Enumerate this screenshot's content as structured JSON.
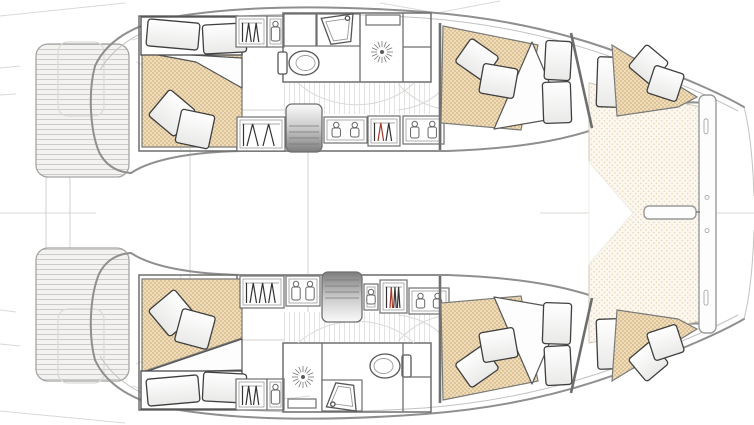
{
  "diagram": {
    "kind": "catamaran-floor-plan",
    "view": "deck-plan-top-view",
    "vessel": {
      "hulls": 2,
      "double_cabins": 4,
      "bathrooms": 2,
      "trampoline": true,
      "swim_platforms": 2
    }
  },
  "colors": {
    "background": "#ffffff",
    "hull_outline": "#8f8f8f",
    "wall": "#6e6e6e",
    "faint_deck": "#d9d9d7",
    "mattress_fill": "#eedcbb",
    "mattress_dot": "#c69f62",
    "trampoline_fill": "#fcf8f0",
    "trampoline_dot": "#e6d5b4",
    "plank_fill": "#f3f2f0",
    "plank_line": "#cbcbc9",
    "vplank_line": "#e3e3e1",
    "steps_dark": "#7d7d7d",
    "pillow_stroke": "#3f3f3f",
    "hanger_accent_red": "#a33a2a"
  },
  "canvas": {
    "width": 754,
    "height": 425
  },
  "items": [
    {
      "t": "line",
      "x1": 0,
      "y1": 16,
      "x2": 125,
      "y2": 3,
      "cls": "faint",
      "name": "stern-rig-line-top"
    },
    {
      "t": "line",
      "x1": 0,
      "y1": 411,
      "x2": 125,
      "y2": 423,
      "cls": "faint",
      "name": "stern-rig-line-bottom"
    },
    {
      "t": "line",
      "x1": 0,
      "y1": 68,
      "x2": 20,
      "y2": 66,
      "cls": "faint",
      "name": "edge-tick"
    },
    {
      "t": "line",
      "x1": 0,
      "y1": 95,
      "x2": 16,
      "y2": 94,
      "cls": "faint",
      "name": "edge-tick"
    },
    {
      "t": "line",
      "x1": 0,
      "y1": 310,
      "x2": 16,
      "y2": 312,
      "cls": "faint",
      "name": "edge-tick"
    },
    {
      "t": "line",
      "x1": 0,
      "y1": 344,
      "x2": 20,
      "y2": 346,
      "cls": "faint",
      "name": "edge-tick"
    },
    {
      "t": "line",
      "x1": 0,
      "y1": 213,
      "x2": 96,
      "y2": 213,
      "cls": "faint",
      "name": "centerline-aft"
    },
    {
      "t": "line",
      "x1": 540,
      "y1": 213,
      "x2": 644,
      "y2": 213,
      "cls": "faint",
      "name": "centerline-fwd"
    },
    {
      "t": "line",
      "x1": 697,
      "y1": 213,
      "x2": 754,
      "y2": 213,
      "cls": "faint",
      "name": "centerline-bow"
    },
    {
      "t": "path",
      "d": "M380,3 L437,13 L500,1",
      "cls": "faint",
      "name": "rig-lines-top"
    },
    {
      "t": "rect",
      "x": 190,
      "y": 110,
      "w": 118,
      "h": 230,
      "rx": 16,
      "cls": "faintbox",
      "name": "cockpit-outline"
    },
    {
      "t": "rect",
      "x": 46,
      "y": 172,
      "w": 24,
      "h": 84,
      "rx": 9,
      "cls": "faintbox",
      "name": "aft-platform-outline"
    },
    {
      "t": "path",
      "d": "M132,40 C180,26 250,22 310,30",
      "cls": "faint",
      "name": "cockpit-seat-line"
    },
    {
      "t": "path",
      "d": "M132,386 C180,400 250,404 310,396",
      "cls": "faint",
      "name": "cockpit-seat-line"
    },
    {
      "t": "path",
      "d": "M136,62 C168,74 178,112 181,152",
      "cls": "faint",
      "name": "cockpit-seat-line"
    },
    {
      "t": "path",
      "d": "M136,364 C168,352 178,314 181,274",
      "cls": "faint",
      "name": "cockpit-seat-line"
    },
    {
      "t": "path",
      "d": "M744,107 C750,130 753,165 754,196",
      "cls": "hullthin",
      "name": "bow-bridle-top"
    },
    {
      "t": "path",
      "d": "M744,319 C750,296 753,261 754,230",
      "cls": "hullthin",
      "name": "bow-bridle-bottom"
    },
    {
      "t": "planks",
      "x": 36,
      "y": 44,
      "w": 93,
      "h": 133,
      "rx": 12,
      "name": "swim-platform-top"
    },
    {
      "t": "rect",
      "x": 58,
      "y": 42,
      "w": 46,
      "h": 74,
      "rx": 10,
      "cls": "faintbox",
      "name": "transom-step-outline"
    },
    {
      "t": "planks",
      "x": 36,
      "y": 248,
      "w": 93,
      "h": 133,
      "rx": 12,
      "name": "swim-platform-bottom"
    },
    {
      "t": "rect",
      "x": 58,
      "y": 309,
      "w": 46,
      "h": 74,
      "rx": 10,
      "cls": "faintbox",
      "name": "transom-step-outline"
    },
    {
      "t": "path",
      "d": "M95,66 C105,44 128,28 162,19 C235,5 330,5 425,12 C505,18 575,35 633,58 C684,78 718,92 744,107",
      "cls": "hull",
      "name": "hull-port-outer"
    },
    {
      "t": "path",
      "d": "M100,70 C112,50 132,34 164,25 C236,12 330,12 424,18 C502,24 570,41 628,63 C678,83 712,97 738,111",
      "cls": "hullthin",
      "name": "hull-port-toerail"
    },
    {
      "t": "path",
      "d": "M131,173 C152,159 192,152 242,151 L448,151 C532,148 578,137 617,121 C652,107 680,100 703,103",
      "cls": "hull",
      "name": "hull-port-inner"
    },
    {
      "t": "path",
      "d": "M95,66 C88,92 90,130 99,152 C106,166 117,172 131,173",
      "cls": "hull",
      "name": "hull-port-stern"
    },
    {
      "t": "path",
      "d": "M95,360 C105,382 128,398 162,407 C235,421 330,421 425,414 C505,408 575,391 633,368 C684,348 718,334 744,319",
      "cls": "hull",
      "name": "hull-starboard-outer"
    },
    {
      "t": "path",
      "d": "M100,356 C112,376 132,392 164,401 C236,414 330,414 424,408 C502,402 570,385 628,363 C678,343 712,329 738,315",
      "cls": "hullthin",
      "name": "hull-starboard-toerail"
    },
    {
      "t": "path",
      "d": "M131,253 C152,267 192,274 242,275 L448,275 C532,278 578,289 617,305 C652,319 680,326 703,323",
      "cls": "hull",
      "name": "hull-starboard-inner"
    },
    {
      "t": "path",
      "d": "M95,360 C88,334 90,296 99,274 C106,260 117,254 131,253",
      "cls": "hull",
      "name": "hull-starboard-stern"
    },
    {
      "t": "tramp",
      "pts": [
        [
          589,
          83
        ],
        [
          701,
          107
        ],
        [
          701,
          321
        ],
        [
          589,
          343
        ]
      ],
      "name": "trampoline"
    },
    {
      "t": "poly",
      "pts": [
        [
          589,
          162
        ],
        [
          633,
          213
        ],
        [
          589,
          264
        ]
      ],
      "cls": "wedge",
      "name": "foredeck-wedge"
    },
    {
      "t": "beam",
      "x": 699,
      "y": 95,
      "w": 17,
      "h": 238,
      "name": "forward-crossbeam"
    },
    {
      "t": "bowsprit",
      "x": 644,
      "y": 206,
      "w": 52,
      "h": 13,
      "name": "bowsprit"
    },
    {
      "t": "line",
      "x1": 696,
      "y1": 212,
      "x2": 700,
      "y2": 212,
      "cls": "wall",
      "name": "bowsprit-link"
    },
    {
      "t": "rect",
      "x": 139,
      "y": 16,
      "w": 98,
      "h": 135,
      "cls": "room",
      "name": "aft-cabin-port"
    },
    {
      "t": "mattress",
      "pts": [
        [
          142,
          54
        ],
        [
          242,
          54
        ],
        [
          242,
          147
        ],
        [
          142,
          147
        ]
      ],
      "name": "aft-cabin-port-mattress"
    },
    {
      "t": "duvet",
      "pts": [
        [
          142,
          52
        ],
        [
          242,
          58
        ],
        [
          242,
          88
        ],
        [
          196,
          62
        ]
      ],
      "name": "duvet"
    },
    {
      "t": "rect",
      "x": 141,
      "y": 17,
      "w": 101,
      "h": 38,
      "cls": "bed",
      "name": "aft-cabin-port-bedhead"
    },
    {
      "t": "pillow",
      "x": 147,
      "y": 21,
      "w": 52,
      "h": 27,
      "rot": 5,
      "name": "pillow"
    },
    {
      "t": "pillow",
      "x": 203,
      "y": 24,
      "w": 43,
      "h": 29,
      "rot": -3,
      "name": "pillow"
    },
    {
      "t": "pillow",
      "x": 155,
      "y": 96,
      "w": 34,
      "h": 34,
      "rot": 40,
      "name": "throw-pillow"
    },
    {
      "t": "pillow",
      "x": 178,
      "y": 112,
      "w": 34,
      "h": 34,
      "rot": 12,
      "name": "throw-pillow"
    },
    {
      "t": "locker",
      "x": 236,
      "y": 16,
      "w": 31,
      "h": 31,
      "hangers": 2,
      "name": "wardrobe"
    },
    {
      "t": "shelf",
      "x": 267,
      "y": 16,
      "w": 17,
      "h": 31,
      "jars": 1,
      "name": "shelf-unit"
    },
    {
      "t": "rect",
      "x": 283,
      "y": 13,
      "w": 148,
      "h": 69,
      "cls": "room",
      "name": "bathroom-port"
    },
    {
      "t": "rect",
      "x": 284,
      "y": 14,
      "w": 32,
      "h": 32,
      "cls": "cab",
      "name": "bathroom-cabinet"
    },
    {
      "t": "rect",
      "x": 317,
      "y": 14,
      "w": 43,
      "h": 32,
      "cls": "cab",
      "name": "vanity"
    },
    {
      "t": "sink",
      "x": 322,
      "y": 16,
      "w": 34,
      "h": 27,
      "rot": -8,
      "name": "sink"
    },
    {
      "t": "toilet",
      "cx": 304,
      "cy": 63,
      "facing": "right",
      "name": "toilet"
    },
    {
      "t": "line",
      "x1": 360,
      "y1": 13,
      "x2": 360,
      "y2": 82,
      "cls": "wall",
      "name": "shower-wall"
    },
    {
      "t": "rect",
      "x": 366,
      "y": 15,
      "w": 34,
      "h": 10,
      "cls": "cab",
      "name": "shower-bench"
    },
    {
      "t": "shower",
      "cx": 382,
      "cy": 52,
      "name": "shower-drain"
    },
    {
      "t": "line",
      "x1": 403,
      "y1": 13,
      "x2": 403,
      "y2": 82,
      "cls": "wall",
      "name": "bathroom-wall"
    },
    {
      "t": "line",
      "x1": 403,
      "y1": 47,
      "x2": 431,
      "y2": 47,
      "cls": "wall",
      "name": "cabinet-divider"
    },
    {
      "t": "vfloor",
      "x": 284,
      "y": 83,
      "w": 146,
      "h": 31,
      "name": "corridor-floor"
    },
    {
      "t": "path",
      "d": "M298,83 C330,112 384,112 414,83",
      "cls": "faint",
      "name": "door-swing"
    },
    {
      "t": "path",
      "d": "M398,84 C415,102 432,108 448,110",
      "cls": "faint",
      "name": "floor-mark"
    },
    {
      "t": "path",
      "d": "M448,84 C432,102 415,108 398,110",
      "cls": "faint",
      "name": "floor-mark"
    },
    {
      "t": "locker",
      "x": 237,
      "y": 117,
      "w": 48,
      "h": 34,
      "hangers": 2,
      "name": "hanging-locker"
    },
    {
      "t": "steps",
      "x": 286,
      "y": 104,
      "w": 36,
      "h": 48,
      "dark": "bottom",
      "name": "companionway-steps-port"
    },
    {
      "t": "shelf",
      "x": 324,
      "y": 117,
      "w": 43,
      "h": 26,
      "jars": 2,
      "name": "shelf-unit"
    },
    {
      "t": "locker",
      "x": 368,
      "y": 116,
      "w": 32,
      "h": 30,
      "hangers": 2,
      "red": 1,
      "name": "hanging-locker"
    },
    {
      "t": "shelf",
      "x": 403,
      "y": 116,
      "w": 41,
      "h": 28,
      "jars": 2,
      "name": "shelf-unit"
    },
    {
      "t": "line",
      "x1": 440,
      "y1": 23,
      "x2": 440,
      "y2": 150,
      "cls": "wall2",
      "name": "cabin-bulkhead"
    },
    {
      "t": "mattress",
      "pts": [
        [
          443,
          26
        ],
        [
          538,
          45
        ],
        [
          521,
          130
        ],
        [
          441,
          123
        ]
      ],
      "name": "fwd-cabin-port-mattress"
    },
    {
      "t": "duvet",
      "pts": [
        [
          532,
          42
        ],
        [
          564,
          117
        ],
        [
          494,
          129
        ]
      ],
      "name": "duvet"
    },
    {
      "t": "pillow",
      "x": 460,
      "y": 45,
      "w": 34,
      "h": 29,
      "rot": 35,
      "name": "throw-pillow"
    },
    {
      "t": "pillow",
      "x": 481,
      "y": 66,
      "w": 35,
      "h": 30,
      "rot": 10,
      "name": "throw-pillow"
    },
    {
      "t": "pillow",
      "x": 545,
      "y": 41,
      "w": 26,
      "h": 39,
      "rot": 3,
      "name": "pillow"
    },
    {
      "t": "pillow",
      "x": 543,
      "y": 82,
      "w": 28,
      "h": 41,
      "rot": -2,
      "name": "pillow"
    },
    {
      "t": "line",
      "x1": 571,
      "y1": 33,
      "x2": 592,
      "y2": 128,
      "cls": "wall2",
      "name": "bow-bulkhead"
    },
    {
      "t": "pillow",
      "x": 597,
      "y": 57,
      "w": 22,
      "h": 50,
      "rot": 2,
      "name": "pillow"
    },
    {
      "t": "mattress",
      "pts": [
        [
          612,
          45
        ],
        [
          697,
          97
        ],
        [
          678,
          107
        ],
        [
          617,
          116
        ]
      ],
      "name": "bow-cabin-port-mattress"
    },
    {
      "t": "pillow",
      "x": 634,
      "y": 50,
      "w": 29,
      "h": 29,
      "rot": 40,
      "name": "throw-pillow"
    },
    {
      "t": "pillow",
      "x": 650,
      "y": 69,
      "w": 31,
      "h": 29,
      "rot": 18,
      "name": "throw-pillow"
    },
    {
      "t": "rect",
      "x": 139,
      "y": 275,
      "w": 98,
      "h": 135,
      "cls": "room",
      "name": "aft-cabin-starboard"
    },
    {
      "t": "mattress",
      "pts": [
        [
          142,
          279
        ],
        [
          242,
          279
        ],
        [
          242,
          338
        ],
        [
          142,
          372
        ]
      ],
      "name": "aft-cabin-starboard-mattress"
    },
    {
      "t": "duvet",
      "pts": [
        [
          142,
          373
        ],
        [
          242,
          339
        ],
        [
          242,
          370
        ]
      ],
      "name": "duvet"
    },
    {
      "t": "rect",
      "x": 141,
      "y": 371,
      "w": 101,
      "h": 38,
      "cls": "bed",
      "name": "aft-cabin-starboard-bedhead"
    },
    {
      "t": "pillow",
      "x": 147,
      "y": 377,
      "w": 52,
      "h": 27,
      "rot": -5,
      "name": "pillow"
    },
    {
      "t": "pillow",
      "x": 203,
      "y": 373,
      "w": 43,
      "h": 29,
      "rot": 3,
      "name": "pillow"
    },
    {
      "t": "pillow",
      "x": 155,
      "y": 296,
      "w": 34,
      "h": 34,
      "rot": 50,
      "name": "throw-pillow"
    },
    {
      "t": "pillow",
      "x": 178,
      "y": 312,
      "w": 34,
      "h": 34,
      "rot": 15,
      "name": "throw-pillow"
    },
    {
      "t": "locker",
      "x": 236,
      "y": 379,
      "w": 31,
      "h": 31,
      "hangers": 2,
      "name": "wardrobe"
    },
    {
      "t": "shelf",
      "x": 267,
      "y": 379,
      "w": 17,
      "h": 31,
      "jars": 1,
      "name": "shelf-unit"
    },
    {
      "t": "rect",
      "x": 283,
      "y": 343,
      "w": 148,
      "h": 69,
      "cls": "room",
      "name": "bathroom-starboard"
    },
    {
      "t": "line",
      "x1": 322,
      "y1": 343,
      "x2": 322,
      "y2": 412,
      "cls": "wall",
      "name": "shower-wall"
    },
    {
      "t": "shower",
      "cx": 303,
      "cy": 377,
      "name": "shower-drain"
    },
    {
      "t": "rect",
      "x": 288,
      "y": 399,
      "w": 28,
      "h": 9,
      "cls": "cab",
      "name": "shower-bench"
    },
    {
      "t": "rect",
      "x": 322,
      "y": 380,
      "w": 40,
      "h": 31,
      "cls": "cab",
      "name": "vanity"
    },
    {
      "t": "sink",
      "x": 327,
      "y": 384,
      "w": 32,
      "h": 25,
      "rot": 188,
      "name": "sink"
    },
    {
      "t": "toilet",
      "cx": 385,
      "cy": 366,
      "facing": "left",
      "name": "toilet"
    },
    {
      "t": "line",
      "x1": 403,
      "y1": 343,
      "x2": 403,
      "y2": 412,
      "cls": "wall",
      "name": "bathroom-wall"
    },
    {
      "t": "line",
      "x1": 403,
      "y1": 377,
      "x2": 431,
      "y2": 377,
      "cls": "wall",
      "name": "cabinet-divider"
    },
    {
      "t": "vfloor",
      "x": 284,
      "y": 312,
      "w": 146,
      "h": 30,
      "name": "corridor-floor"
    },
    {
      "t": "path",
      "d": "M298,343 C330,314 384,314 414,343",
      "cls": "faint",
      "name": "door-swing"
    },
    {
      "t": "path",
      "d": "M398,341 C415,323 432,317 448,315",
      "cls": "faint",
      "name": "floor-mark"
    },
    {
      "t": "path",
      "d": "M448,341 C432,323 415,317 398,315",
      "cls": "faint",
      "name": "floor-mark"
    },
    {
      "t": "locker",
      "x": 240,
      "y": 276,
      "w": 44,
      "h": 32,
      "hangers": 3,
      "name": "hanging-locker"
    },
    {
      "t": "shelf",
      "x": 286,
      "y": 276,
      "w": 34,
      "h": 30,
      "jars": 2,
      "name": "shelf-unit"
    },
    {
      "t": "steps",
      "x": 322,
      "y": 272,
      "w": 40,
      "h": 50,
      "dark": "top",
      "name": "companionway-steps-starboard"
    },
    {
      "t": "shelf",
      "x": 364,
      "y": 284,
      "w": 14,
      "h": 26,
      "jars": 1,
      "name": "shelf-unit"
    },
    {
      "t": "locker",
      "x": 380,
      "y": 280,
      "w": 27,
      "h": 33,
      "hangers": 3,
      "red": 1,
      "name": "hanging-locker"
    },
    {
      "t": "shelf",
      "x": 409,
      "y": 288,
      "w": 40,
      "h": 26,
      "jars": 2,
      "name": "shelf-unit"
    },
    {
      "t": "line",
      "x1": 440,
      "y1": 276,
      "x2": 440,
      "y2": 403,
      "cls": "wall2",
      "name": "cabin-bulkhead"
    },
    {
      "t": "mattress",
      "pts": [
        [
          443,
          400
        ],
        [
          538,
          381
        ],
        [
          521,
          296
        ],
        [
          441,
          303
        ]
      ],
      "name": "fwd-cabin-starboard-mattress"
    },
    {
      "t": "duvet",
      "pts": [
        [
          532,
          384
        ],
        [
          564,
          309
        ],
        [
          494,
          297
        ]
      ],
      "name": "duvet"
    },
    {
      "t": "pillow",
      "x": 460,
      "y": 352,
      "w": 34,
      "h": 29,
      "rot": -35,
      "name": "throw-pillow"
    },
    {
      "t": "pillow",
      "x": 481,
      "y": 330,
      "w": 35,
      "h": 30,
      "rot": -10,
      "name": "throw-pillow"
    },
    {
      "t": "pillow",
      "x": 545,
      "y": 346,
      "w": 26,
      "h": 39,
      "rot": -3,
      "name": "pillow"
    },
    {
      "t": "pillow",
      "x": 543,
      "y": 303,
      "w": 28,
      "h": 41,
      "rot": 2,
      "name": "pillow"
    },
    {
      "t": "line",
      "x1": 571,
      "y1": 393,
      "x2": 592,
      "y2": 298,
      "cls": "wall2",
      "name": "bow-bulkhead"
    },
    {
      "t": "pillow",
      "x": 597,
      "y": 319,
      "w": 22,
      "h": 50,
      "rot": -2,
      "name": "pillow"
    },
    {
      "t": "mattress",
      "pts": [
        [
          612,
          381
        ],
        [
          697,
          329
        ],
        [
          678,
          319
        ],
        [
          617,
          310
        ]
      ],
      "name": "bow-cabin-starboard-mattress"
    },
    {
      "t": "pillow",
      "x": 634,
      "y": 347,
      "w": 29,
      "h": 29,
      "rot": -40,
      "name": "throw-pillow"
    },
    {
      "t": "pillow",
      "x": 650,
      "y": 328,
      "w": 31,
      "h": 29,
      "rot": -18,
      "name": "throw-pillow"
    }
  ]
}
